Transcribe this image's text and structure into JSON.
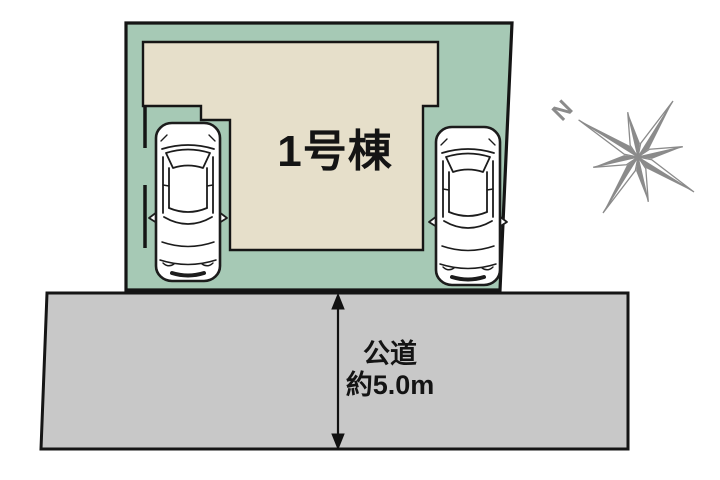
{
  "diagram": {
    "title_note": "site plan",
    "building": {
      "label": "1号棟"
    },
    "road": {
      "name": "公道",
      "width_value": "約5.0m"
    },
    "compass": {
      "north_label": "N"
    },
    "colors": {
      "lot_green": "#a6c9b5",
      "building_beige": "#e6dfca",
      "road_gray": "#c8c8c8",
      "outline_black": "#151515",
      "compass_gray": "#8b8b8b",
      "car_white": "#ffffff"
    },
    "icons": {
      "left_vehicle": "car-top-view-icon",
      "right_vehicle": "car-top-view-icon",
      "compass": "compass-rose-icon",
      "road_measure": "double-arrow-icon"
    }
  }
}
